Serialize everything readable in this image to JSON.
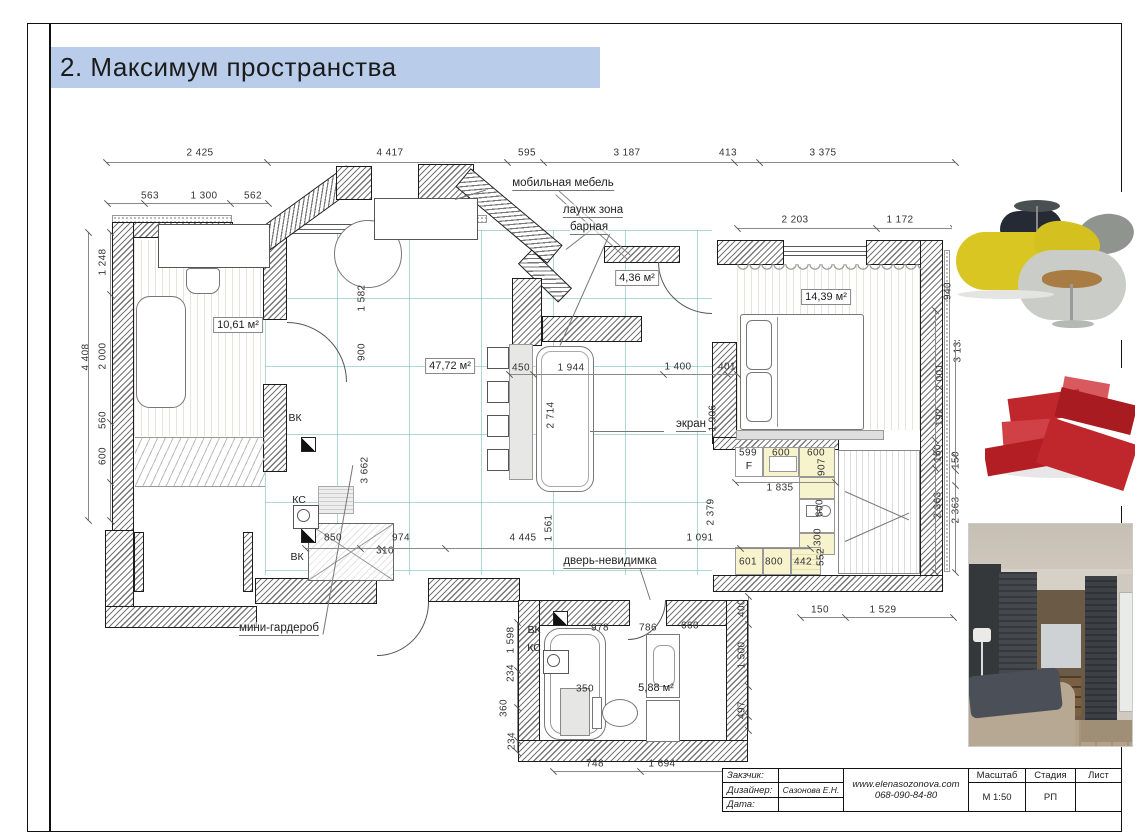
{
  "page": {
    "title": "2. Максимум пространства"
  },
  "colors": {
    "title_bg": "#b9cdeb",
    "grid_teal": "#409e9e",
    "kitchen_yellow": "#f7f3cd",
    "pouf_yellow": "#d9c623",
    "sofa_red": "#c0272c"
  },
  "plan": {
    "dims": [
      {
        "text": "2 425",
        "x": 200,
        "y": 153
      },
      {
        "text": "4 417",
        "x": 390,
        "y": 153
      },
      {
        "text": "595",
        "x": 527,
        "y": 153
      },
      {
        "text": "3 187",
        "x": 627,
        "y": 153
      },
      {
        "text": "413",
        "x": 728,
        "y": 153
      },
      {
        "text": "3 375",
        "x": 823,
        "y": 153
      },
      {
        "text": "563",
        "x": 150,
        "y": 196
      },
      {
        "text": "1 300",
        "x": 204,
        "y": 196
      },
      {
        "text": "562",
        "x": 253,
        "y": 196
      },
      {
        "text": "2 203",
        "x": 795,
        "y": 220
      },
      {
        "text": "1 172",
        "x": 900,
        "y": 220
      },
      {
        "text": "4 408",
        "x": 86,
        "y": 357,
        "cls": "rot"
      },
      {
        "text": "1 248",
        "x": 103,
        "y": 262,
        "cls": "rot"
      },
      {
        "text": "2 000",
        "x": 103,
        "y": 356,
        "cls": "rot"
      },
      {
        "text": "560",
        "x": 103,
        "y": 420,
        "cls": "rot"
      },
      {
        "text": "600",
        "x": 103,
        "y": 456,
        "cls": "rot"
      },
      {
        "text": "1 582",
        "x": 362,
        "y": 298,
        "cls": "rot"
      },
      {
        "text": "900",
        "x": 362,
        "y": 352,
        "cls": "rot"
      },
      {
        "text": "3 662",
        "x": 365,
        "y": 470,
        "cls": "rot"
      },
      {
        "text": "450",
        "x": 521,
        "y": 368
      },
      {
        "text": "1 944",
        "x": 571,
        "y": 368
      },
      {
        "text": "1 400",
        "x": 678,
        "y": 367
      },
      {
        "text": "401",
        "x": 727,
        "y": 367
      },
      {
        "text": "2 714",
        "x": 551,
        "y": 415,
        "cls": "rot"
      },
      {
        "text": "1 906",
        "x": 713,
        "y": 418,
        "cls": "rot"
      },
      {
        "text": "940",
        "x": 948,
        "y": 291,
        "cls": "rot"
      },
      {
        "text": "3 133",
        "x": 958,
        "y": 349,
        "cls": "rot"
      },
      {
        "text": "2 001",
        "x": 940,
        "y": 377,
        "cls": "rot"
      },
      {
        "text": "192",
        "x": 940,
        "y": 417,
        "cls": "rot"
      },
      {
        "text": "150",
        "x": 938,
        "y": 453,
        "cls": "rot"
      },
      {
        "text": "150",
        "x": 956,
        "y": 460,
        "cls": "rot"
      },
      {
        "text": "2 363",
        "x": 938,
        "y": 505,
        "cls": "rot"
      },
      {
        "text": "2 363",
        "x": 956,
        "y": 510,
        "cls": "rot"
      },
      {
        "text": "599",
        "x": 748,
        "y": 453
      },
      {
        "text": "600",
        "x": 781,
        "y": 453
      },
      {
        "text": "600",
        "x": 816,
        "y": 453
      },
      {
        "text": "907",
        "x": 822,
        "y": 467,
        "cls": "rot"
      },
      {
        "text": "1 835",
        "x": 780,
        "y": 488
      },
      {
        "text": "2 379",
        "x": 711,
        "y": 512,
        "cls": "rot"
      },
      {
        "text": "600",
        "x": 820,
        "y": 508,
        "cls": "rot"
      },
      {
        "text": "300",
        "x": 818,
        "y": 537,
        "cls": "rot"
      },
      {
        "text": "552",
        "x": 821,
        "y": 557,
        "cls": "rot"
      },
      {
        "text": "601",
        "x": 748,
        "y": 562
      },
      {
        "text": "800",
        "x": 774,
        "y": 562
      },
      {
        "text": "442",
        "x": 803,
        "y": 562
      },
      {
        "text": "1 091",
        "x": 700,
        "y": 538
      },
      {
        "text": "850",
        "x": 333,
        "y": 538
      },
      {
        "text": "310",
        "x": 385,
        "y": 551
      },
      {
        "text": "974",
        "x": 401,
        "y": 538
      },
      {
        "text": "4 445",
        "x": 523,
        "y": 538
      },
      {
        "text": "1 561",
        "x": 549,
        "y": 528,
        "cls": "rot"
      },
      {
        "text": "1 598",
        "x": 511,
        "y": 640,
        "cls": "rot"
      },
      {
        "text": "234",
        "x": 511,
        "y": 673,
        "cls": "rot"
      },
      {
        "text": "360",
        "x": 504,
        "y": 708,
        "cls": "rot"
      },
      {
        "text": "234",
        "x": 512,
        "y": 741,
        "cls": "rot"
      },
      {
        "text": "400",
        "x": 742,
        "y": 608,
        "cls": "rot"
      },
      {
        "text": "1 500",
        "x": 742,
        "y": 655,
        "cls": "rot"
      },
      {
        "text": "497",
        "x": 742,
        "y": 710,
        "cls": "rot"
      },
      {
        "text": "978",
        "x": 600,
        "y": 628
      },
      {
        "text": "786",
        "x": 648,
        "y": 628
      },
      {
        "text": "660",
        "x": 690,
        "y": 626
      },
      {
        "text": "350",
        "x": 585,
        "y": 689
      },
      {
        "text": "748",
        "x": 595,
        "y": 764
      },
      {
        "text": "1 694",
        "x": 662,
        "y": 764
      },
      {
        "text": "150",
        "x": 820,
        "y": 610
      },
      {
        "text": "1 529",
        "x": 883,
        "y": 610
      }
    ],
    "areas": [
      {
        "text": "10,61 м²",
        "x": 238,
        "y": 325,
        "cls": "boxed"
      },
      {
        "text": "47,72 м²",
        "x": 450,
        "y": 366,
        "cls": "boxed"
      },
      {
        "text": "4,36 м²",
        "x": 637,
        "y": 278,
        "cls": "boxed"
      },
      {
        "text": "14,39 м²",
        "x": 826,
        "y": 297,
        "cls": "boxed"
      },
      {
        "text": "5,88 м²",
        "x": 656,
        "y": 688
      }
    ],
    "annotations": [
      {
        "text": "мобильная мебель",
        "x": 563,
        "y": 184
      },
      {
        "text": "лаунж зона",
        "x": 593,
        "y": 211
      },
      {
        "text": "барная",
        "x": 589,
        "y": 228
      },
      {
        "text": "экран",
        "x": 691,
        "y": 425
      },
      {
        "text": "дверь-невидимка",
        "x": 610,
        "y": 562
      },
      {
        "text": "мини-гардероб",
        "x": 279,
        "y": 629
      }
    ],
    "tech_labels": [
      {
        "text": "ВК",
        "x": 295,
        "y": 418
      },
      {
        "text": "КС",
        "x": 299,
        "y": 500
      },
      {
        "text": "ВК",
        "x": 297,
        "y": 557
      },
      {
        "text": "ВК",
        "x": 534,
        "y": 630
      },
      {
        "text": "КС",
        "x": 534,
        "y": 648
      },
      {
        "text": "F",
        "x": 749,
        "y": 466
      }
    ],
    "dim_lines": [
      {
        "x": 106,
        "y": 162,
        "len": 849,
        "vert": false,
        "ticks": [
          0,
          161,
          401,
          437,
          628,
          653,
          849
        ]
      },
      {
        "x": 107,
        "y": 203,
        "len": 161,
        "vert": false,
        "ticks": [
          0,
          37,
          123,
          161
        ]
      },
      {
        "x": 737,
        "y": 228,
        "len": 216,
        "vert": false,
        "ticks": [
          0,
          139,
          216
        ]
      },
      {
        "x": 88,
        "y": 232,
        "len": 288,
        "vert": true,
        "ticks": [
          0,
          288
        ]
      },
      {
        "x": 110,
        "y": 232,
        "len": 288,
        "vert": true,
        "ticks": [
          0,
          62,
          190,
          250,
          288
        ]
      },
      {
        "x": 935,
        "y": 310,
        "len": 262,
        "vert": true,
        "ticks": [
          0,
          130,
          142,
          158,
          262
        ]
      },
      {
        "x": 955,
        "y": 250,
        "len": 322,
        "vert": true,
        "ticks": [
          0,
          64,
          206,
          220,
          235,
          322
        ]
      },
      {
        "x": 509,
        "y": 374,
        "len": 228,
        "vert": false,
        "ticks": [
          0,
          24,
          154,
          218,
          228
        ]
      },
      {
        "x": 305,
        "y": 548,
        "len": 505,
        "vert": false,
        "ticks": [
          0,
          55,
          76,
          140,
          435,
          505
        ]
      },
      {
        "x": 517,
        "y": 622,
        "len": 130,
        "vert": true,
        "ticks": [
          0,
          48,
          85,
          118,
          130
        ]
      },
      {
        "x": 748,
        "y": 596,
        "len": 134,
        "vert": true,
        "ticks": [
          0,
          28,
          90,
          120,
          134
        ]
      },
      {
        "x": 553,
        "y": 771,
        "len": 204,
        "vert": false,
        "ticks": [
          0,
          87,
          204
        ]
      },
      {
        "x": 800,
        "y": 617,
        "len": 153,
        "vert": false,
        "ticks": [
          0,
          45,
          153
        ]
      },
      {
        "x": 735,
        "y": 482,
        "len": 100,
        "vert": false,
        "ticks": [
          0,
          100
        ]
      }
    ]
  },
  "images": [
    {
      "name": "poufs-lounge-furniture"
    },
    {
      "name": "red-modular-sofa"
    },
    {
      "name": "bedroom-wardrobe-photo"
    }
  ],
  "title_block": {
    "customer_label": "Закзчик:",
    "designer_label": "Дизайнер:",
    "designer_value": "Сазонова Е.Н.",
    "date_label": "Дата:",
    "website": "www.elenasozonova.com",
    "phone": "068-090-84-80",
    "scale_label": "Масштаб",
    "scale_value": "М 1:50",
    "stage_label": "Стадия",
    "stage_value": "РП",
    "sheet_label": "Лист",
    "sheet_value": ""
  }
}
